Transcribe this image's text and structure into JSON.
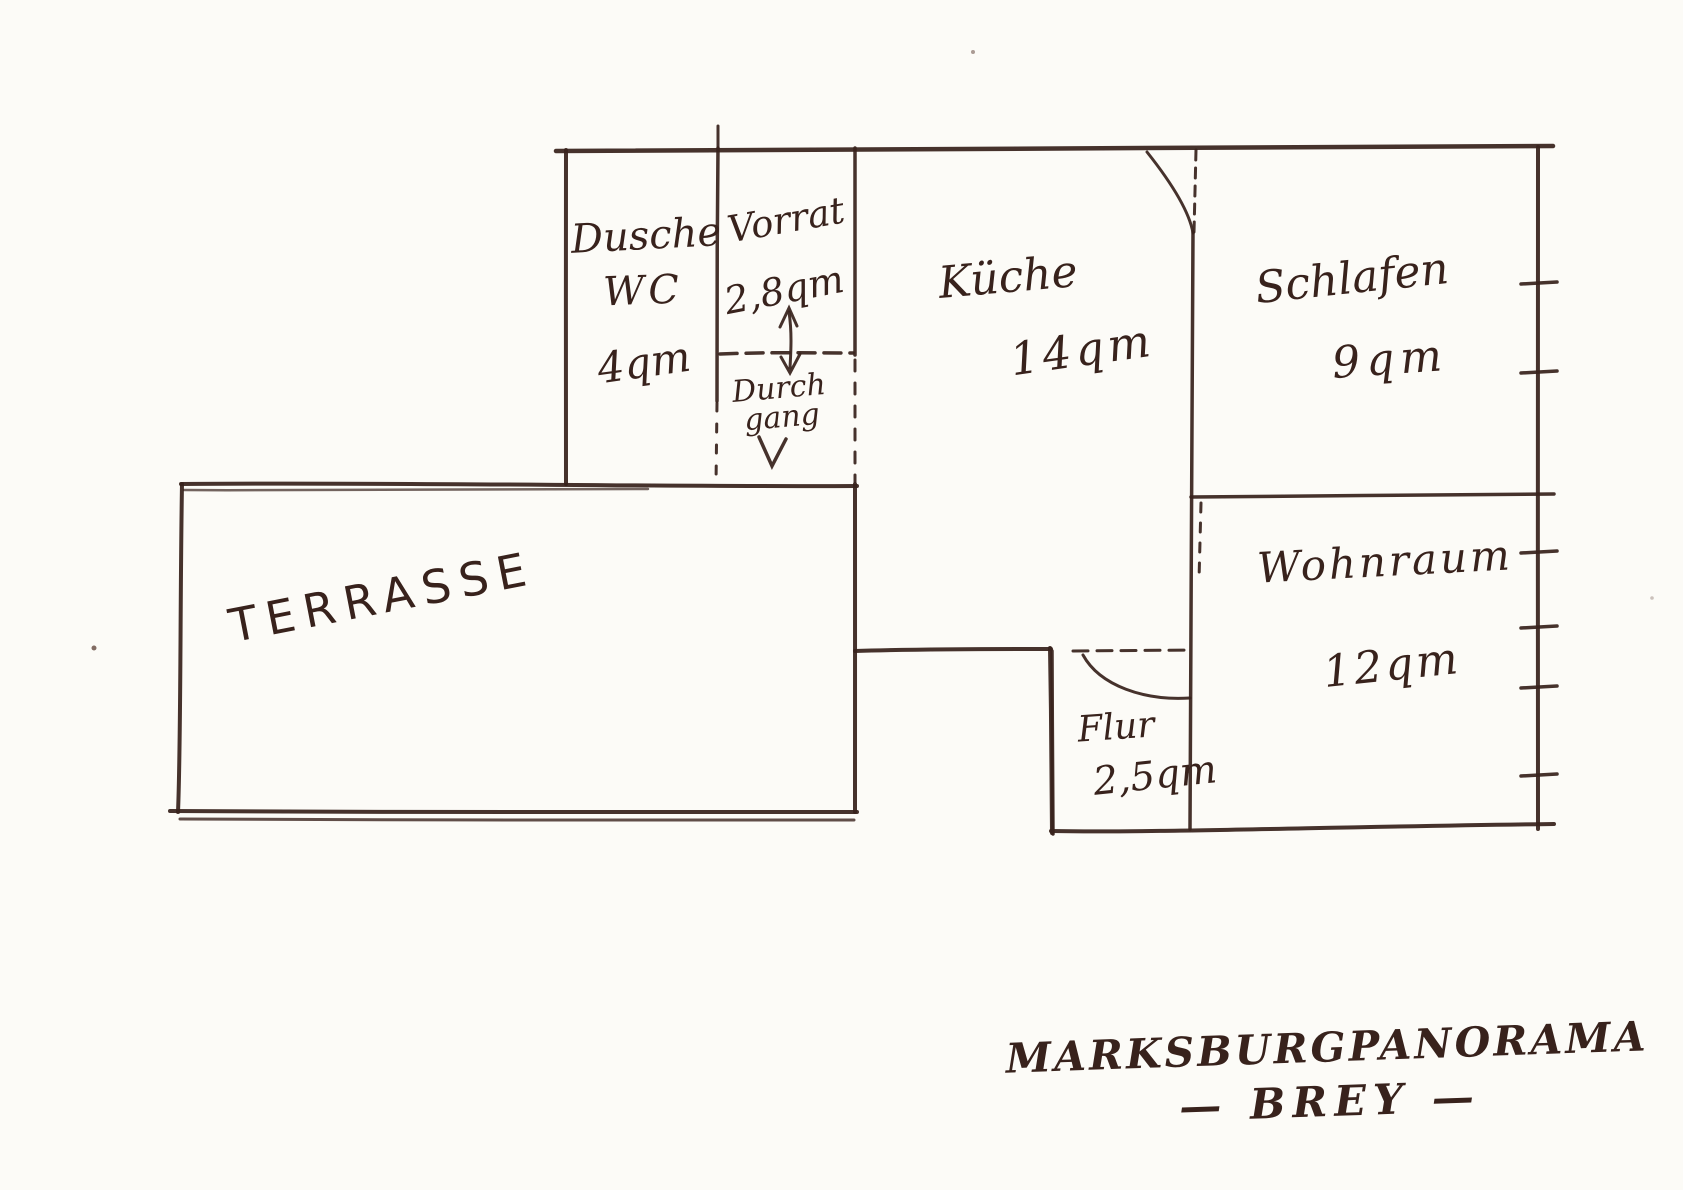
{
  "rooms": {
    "dusche": {
      "name": "Dusche",
      "name2": "WC",
      "area": "4qm"
    },
    "vorrat": {
      "name": "Vorrat",
      "area": "2,8qm"
    },
    "durchgang": {
      "name": "Durch",
      "name2": "gang"
    },
    "kueche": {
      "name": "Küche",
      "area": "14qm"
    },
    "schlafen": {
      "name": "Schlafen",
      "area": "9qm"
    },
    "wohnraum": {
      "name": "Wohnraum",
      "area": "12qm"
    },
    "flur": {
      "name": "Flur",
      "area": "2,5qm"
    },
    "terrasse": {
      "name": "TERRASSE"
    }
  },
  "footer": {
    "line1": "MARKSBURGPANORAMA",
    "line2": "— BREY —"
  },
  "colors": {
    "ink": "#38221c",
    "paper": "#fcfbf7"
  }
}
